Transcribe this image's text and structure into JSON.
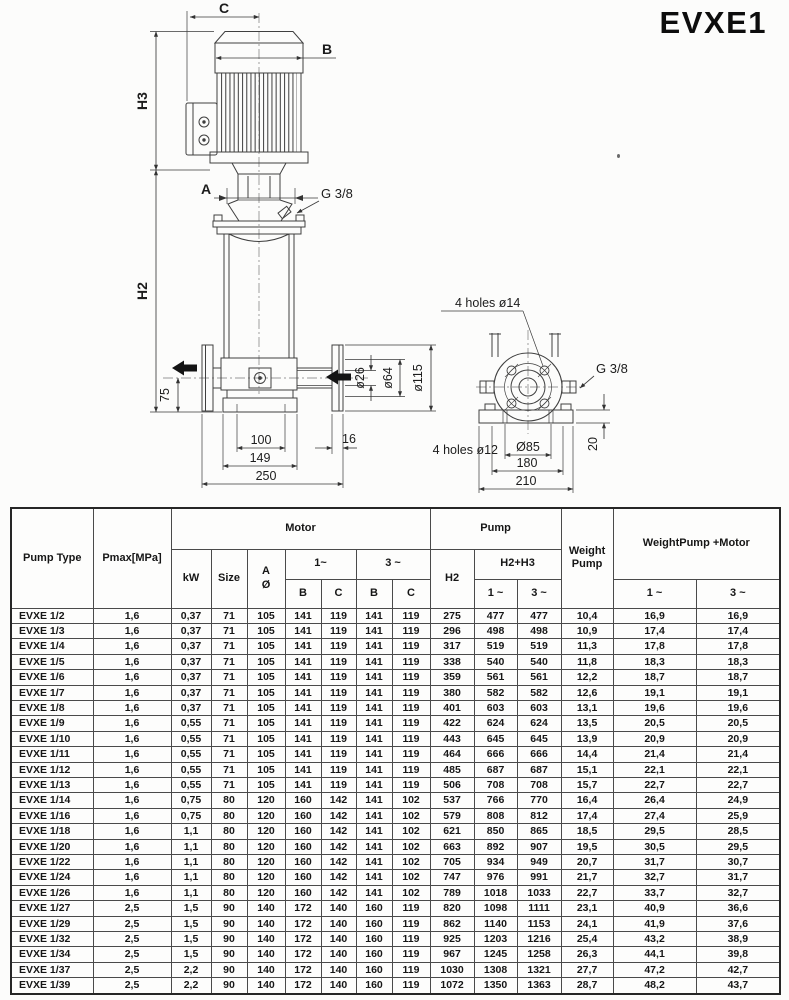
{
  "title": "EVXE1",
  "drawing": {
    "c": "C",
    "b": "B",
    "h3": "H3",
    "h2": "H2",
    "a": "A",
    "g38_top": "G 3/8",
    "n75": "75",
    "d26": "ø26",
    "d64": "ø64",
    "d115": "ø115",
    "n100": "100",
    "n149": "149",
    "n250": "250",
    "n16": "16",
    "holes14": "4 holes ø14",
    "g38_side": "G 3/8",
    "holes12": "4 holes ø12",
    "d85": "Ø85",
    "n180": "180",
    "n210": "210",
    "n20": "20"
  },
  "table": {
    "headers": {
      "pump_type": "Pump Type",
      "pmax": "Pmax[MPa]",
      "motor": "Motor",
      "pump": "Pump",
      "kw": "kW",
      "size": "Size",
      "a_top": "A",
      "a_bottom": "Ø",
      "one": "1~",
      "three": "3 ~",
      "b": "B",
      "c": "C",
      "h2": "H2",
      "h2h3": "H2+H3",
      "weight_pump": "Weight Pump",
      "weight_pump_motor": "WeightPump +Motor",
      "sub_one": "1 ~",
      "sub_three": "3 ~"
    },
    "rows": [
      [
        "EVXE 1/2",
        "1,6",
        "0,37",
        "71",
        "105",
        "141",
        "119",
        "141",
        "119",
        "275",
        "477",
        "477",
        "10,4",
        "16,9",
        "16,9"
      ],
      [
        "EVXE 1/3",
        "1,6",
        "0,37",
        "71",
        "105",
        "141",
        "119",
        "141",
        "119",
        "296",
        "498",
        "498",
        "10,9",
        "17,4",
        "17,4"
      ],
      [
        "EVXE 1/4",
        "1,6",
        "0,37",
        "71",
        "105",
        "141",
        "119",
        "141",
        "119",
        "317",
        "519",
        "519",
        "11,3",
        "17,8",
        "17,8"
      ],
      [
        "EVXE 1/5",
        "1,6",
        "0,37",
        "71",
        "105",
        "141",
        "119",
        "141",
        "119",
        "338",
        "540",
        "540",
        "11,8",
        "18,3",
        "18,3"
      ],
      [
        "EVXE 1/6",
        "1,6",
        "0,37",
        "71",
        "105",
        "141",
        "119",
        "141",
        "119",
        "359",
        "561",
        "561",
        "12,2",
        "18,7",
        "18,7"
      ],
      [
        "EVXE 1/7",
        "1,6",
        "0,37",
        "71",
        "105",
        "141",
        "119",
        "141",
        "119",
        "380",
        "582",
        "582",
        "12,6",
        "19,1",
        "19,1"
      ],
      [
        "EVXE 1/8",
        "1,6",
        "0,37",
        "71",
        "105",
        "141",
        "119",
        "141",
        "119",
        "401",
        "603",
        "603",
        "13,1",
        "19,6",
        "19,6"
      ],
      [
        "EVXE 1/9",
        "1,6",
        "0,55",
        "71",
        "105",
        "141",
        "119",
        "141",
        "119",
        "422",
        "624",
        "624",
        "13,5",
        "20,5",
        "20,5"
      ],
      [
        "EVXE 1/10",
        "1,6",
        "0,55",
        "71",
        "105",
        "141",
        "119",
        "141",
        "119",
        "443",
        "645",
        "645",
        "13,9",
        "20,9",
        "20,9"
      ],
      [
        "EVXE 1/11",
        "1,6",
        "0,55",
        "71",
        "105",
        "141",
        "119",
        "141",
        "119",
        "464",
        "666",
        "666",
        "14,4",
        "21,4",
        "21,4"
      ],
      [
        "EVXE 1/12",
        "1,6",
        "0,55",
        "71",
        "105",
        "141",
        "119",
        "141",
        "119",
        "485",
        "687",
        "687",
        "15,1",
        "22,1",
        "22,1"
      ],
      [
        "EVXE 1/13",
        "1,6",
        "0,55",
        "71",
        "105",
        "141",
        "119",
        "141",
        "119",
        "506",
        "708",
        "708",
        "15,7",
        "22,7",
        "22,7"
      ],
      [
        "EVXE 1/14",
        "1,6",
        "0,75",
        "80",
        "120",
        "160",
        "142",
        "141",
        "102",
        "537",
        "766",
        "770",
        "16,4",
        "26,4",
        "24,9"
      ],
      [
        "EVXE 1/16",
        "1,6",
        "0,75",
        "80",
        "120",
        "160",
        "142",
        "141",
        "102",
        "579",
        "808",
        "812",
        "17,4",
        "27,4",
        "25,9"
      ],
      [
        "EVXE 1/18",
        "1,6",
        "1,1",
        "80",
        "120",
        "160",
        "142",
        "141",
        "102",
        "621",
        "850",
        "865",
        "18,5",
        "29,5",
        "28,5"
      ],
      [
        "EVXE 1/20",
        "1,6",
        "1,1",
        "80",
        "120",
        "160",
        "142",
        "141",
        "102",
        "663",
        "892",
        "907",
        "19,5",
        "30,5",
        "29,5"
      ],
      [
        "EVXE 1/22",
        "1,6",
        "1,1",
        "80",
        "120",
        "160",
        "142",
        "141",
        "102",
        "705",
        "934",
        "949",
        "20,7",
        "31,7",
        "30,7"
      ],
      [
        "EVXE 1/24",
        "1,6",
        "1,1",
        "80",
        "120",
        "160",
        "142",
        "141",
        "102",
        "747",
        "976",
        "991",
        "21,7",
        "32,7",
        "31,7"
      ],
      [
        "EVXE 1/26",
        "1,6",
        "1,1",
        "80",
        "120",
        "160",
        "142",
        "141",
        "102",
        "789",
        "1018",
        "1033",
        "22,7",
        "33,7",
        "32,7"
      ],
      [
        "EVXE 1/27",
        "2,5",
        "1,5",
        "90",
        "140",
        "172",
        "140",
        "160",
        "119",
        "820",
        "1098",
        "1111",
        "23,1",
        "40,9",
        "36,6"
      ],
      [
        "EVXE 1/29",
        "2,5",
        "1,5",
        "90",
        "140",
        "172",
        "140",
        "160",
        "119",
        "862",
        "1140",
        "1153",
        "24,1",
        "41,9",
        "37,6"
      ],
      [
        "EVXE 1/32",
        "2,5",
        "1,5",
        "90",
        "140",
        "172",
        "140",
        "160",
        "119",
        "925",
        "1203",
        "1216",
        "25,4",
        "43,2",
        "38,9"
      ],
      [
        "EVXE 1/34",
        "2,5",
        "1,5",
        "90",
        "140",
        "172",
        "140",
        "160",
        "119",
        "967",
        "1245",
        "1258",
        "26,3",
        "44,1",
        "39,8"
      ],
      [
        "EVXE 1/37",
        "2,5",
        "2,2",
        "90",
        "140",
        "172",
        "140",
        "160",
        "119",
        "1030",
        "1308",
        "1321",
        "27,7",
        "47,2",
        "42,7"
      ],
      [
        "EVXE 1/39",
        "2,5",
        "2,2",
        "90",
        "140",
        "172",
        "140",
        "160",
        "119",
        "1072",
        "1350",
        "1363",
        "28,7",
        "48,2",
        "43,7"
      ]
    ]
  }
}
